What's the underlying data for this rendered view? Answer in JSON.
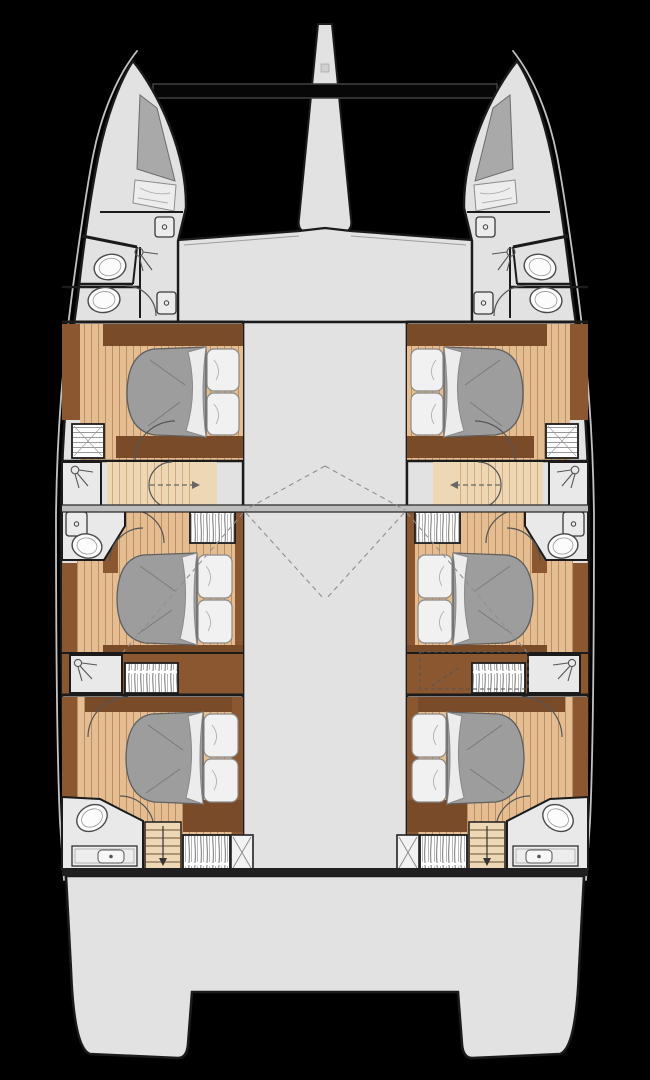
{
  "diagram": {
    "kind": "catamaran-deck-plan",
    "view": "top-down layout plan, hulls pointing up (bows at top), no visible text labels",
    "hulls": 2,
    "symmetry": "port and starboard hulls mirrored about vessel centerline",
    "features": {
      "bow_peaks": {
        "count": 2,
        "contents": [
          "crew-berth-cushion",
          "mattress"
        ]
      },
      "forward_crossbeam_bar": {
        "shape": "long black rectangle between bows",
        "color_ref": "bar"
      },
      "center_nacelle_bow": {
        "shape": "tapered spike at centerline"
      },
      "forward_heads_per_hull": {
        "count": 2,
        "fixtures": [
          "toilet",
          "toilet",
          "shower-head",
          "lockers"
        ]
      },
      "double_cabins": {
        "count": 6,
        "per_hull": 3,
        "bed": "athwartships double with grey duvet outboard and two pillows inboard"
      },
      "midship_walkway": {
        "steps": "timber treads",
        "direction_arrows": 2
      },
      "mid_bathrooms_per_hull": {
        "fixtures": [
          "toilet",
          "vanity-locker",
          "shower-cabin"
        ]
      },
      "aft_bathrooms_per_hull": {
        "fixtures": [
          "toilet",
          "sink-counter",
          "shower-arc"
        ]
      },
      "wardrobes": {
        "count": 8,
        "style": "hatched boxes"
      },
      "companionway_stairs": {
        "count": 2,
        "treads": 6,
        "arrow": "down"
      },
      "technical_hatches_x_marked": {
        "count": 2
      },
      "roofline_dashes": "dashed coachroof / hardtop projection lines over saloon and cabins",
      "aft_platform": {
        "shape": "full-beam transom platform with central cutout between hull sterns"
      }
    }
  },
  "colors": {
    "background": "#000000",
    "hullDeck": "#e2e2e2",
    "wall": "#1b1b1b",
    "rim": "#c2c2c2",
    "woodFloor": "#e4bd93",
    "woodPlank": "#bd8e5e",
    "woodLight": "#eed7b4",
    "woodLightPlank": "#d3ac7e",
    "woodDark": "#8a5730",
    "woodDarkAlt": "#7a4b28",
    "duvet": "#9d9d9d",
    "linen": "#f1f1f1",
    "fixture": "#fcfcfc",
    "band": "#bdbdbd",
    "bar": "#070707",
    "dashes": "#8f8f8f",
    "boxFill": "#e9e9e9"
  }
}
